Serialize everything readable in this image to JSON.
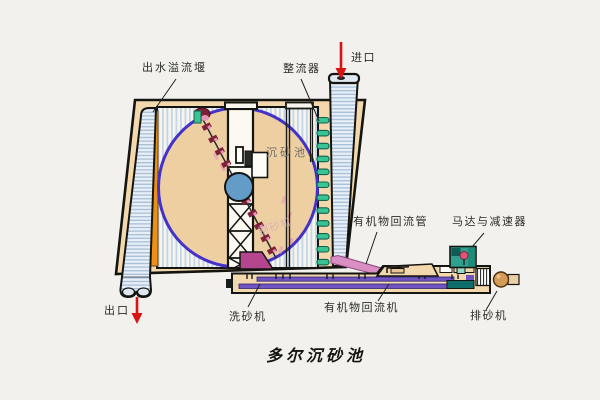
{
  "diagram_title": "多尔沉砂池",
  "labels": {
    "outlet_weir": "出水溢流堰",
    "flow_straightener": "整流器",
    "inlet": "进口",
    "grit_chamber": "沉砂池",
    "scraper": "刮砂机",
    "organic_return_pipe": "有机物回流管",
    "motor_reducer": "马达与减速器",
    "outlet": "出口",
    "sand_washer": "洗砂机",
    "organic_return_machine": "有机物回流机",
    "sand_discharger": "排砂机"
  },
  "colors": {
    "arrow-red": "#d91414",
    "circle-outline": "#4432c8",
    "weir-orange": "#ee9015",
    "vane-green": "#38c493",
    "motor-teal": "#2fa08d",
    "hopper-magenta": "#b4458f",
    "pipe-pink": "#d98ec4",
    "band-purple": "#6f54c2",
    "tank-tan": "#f3d8ae",
    "chain-maroon": "#7c2138"
  }
}
